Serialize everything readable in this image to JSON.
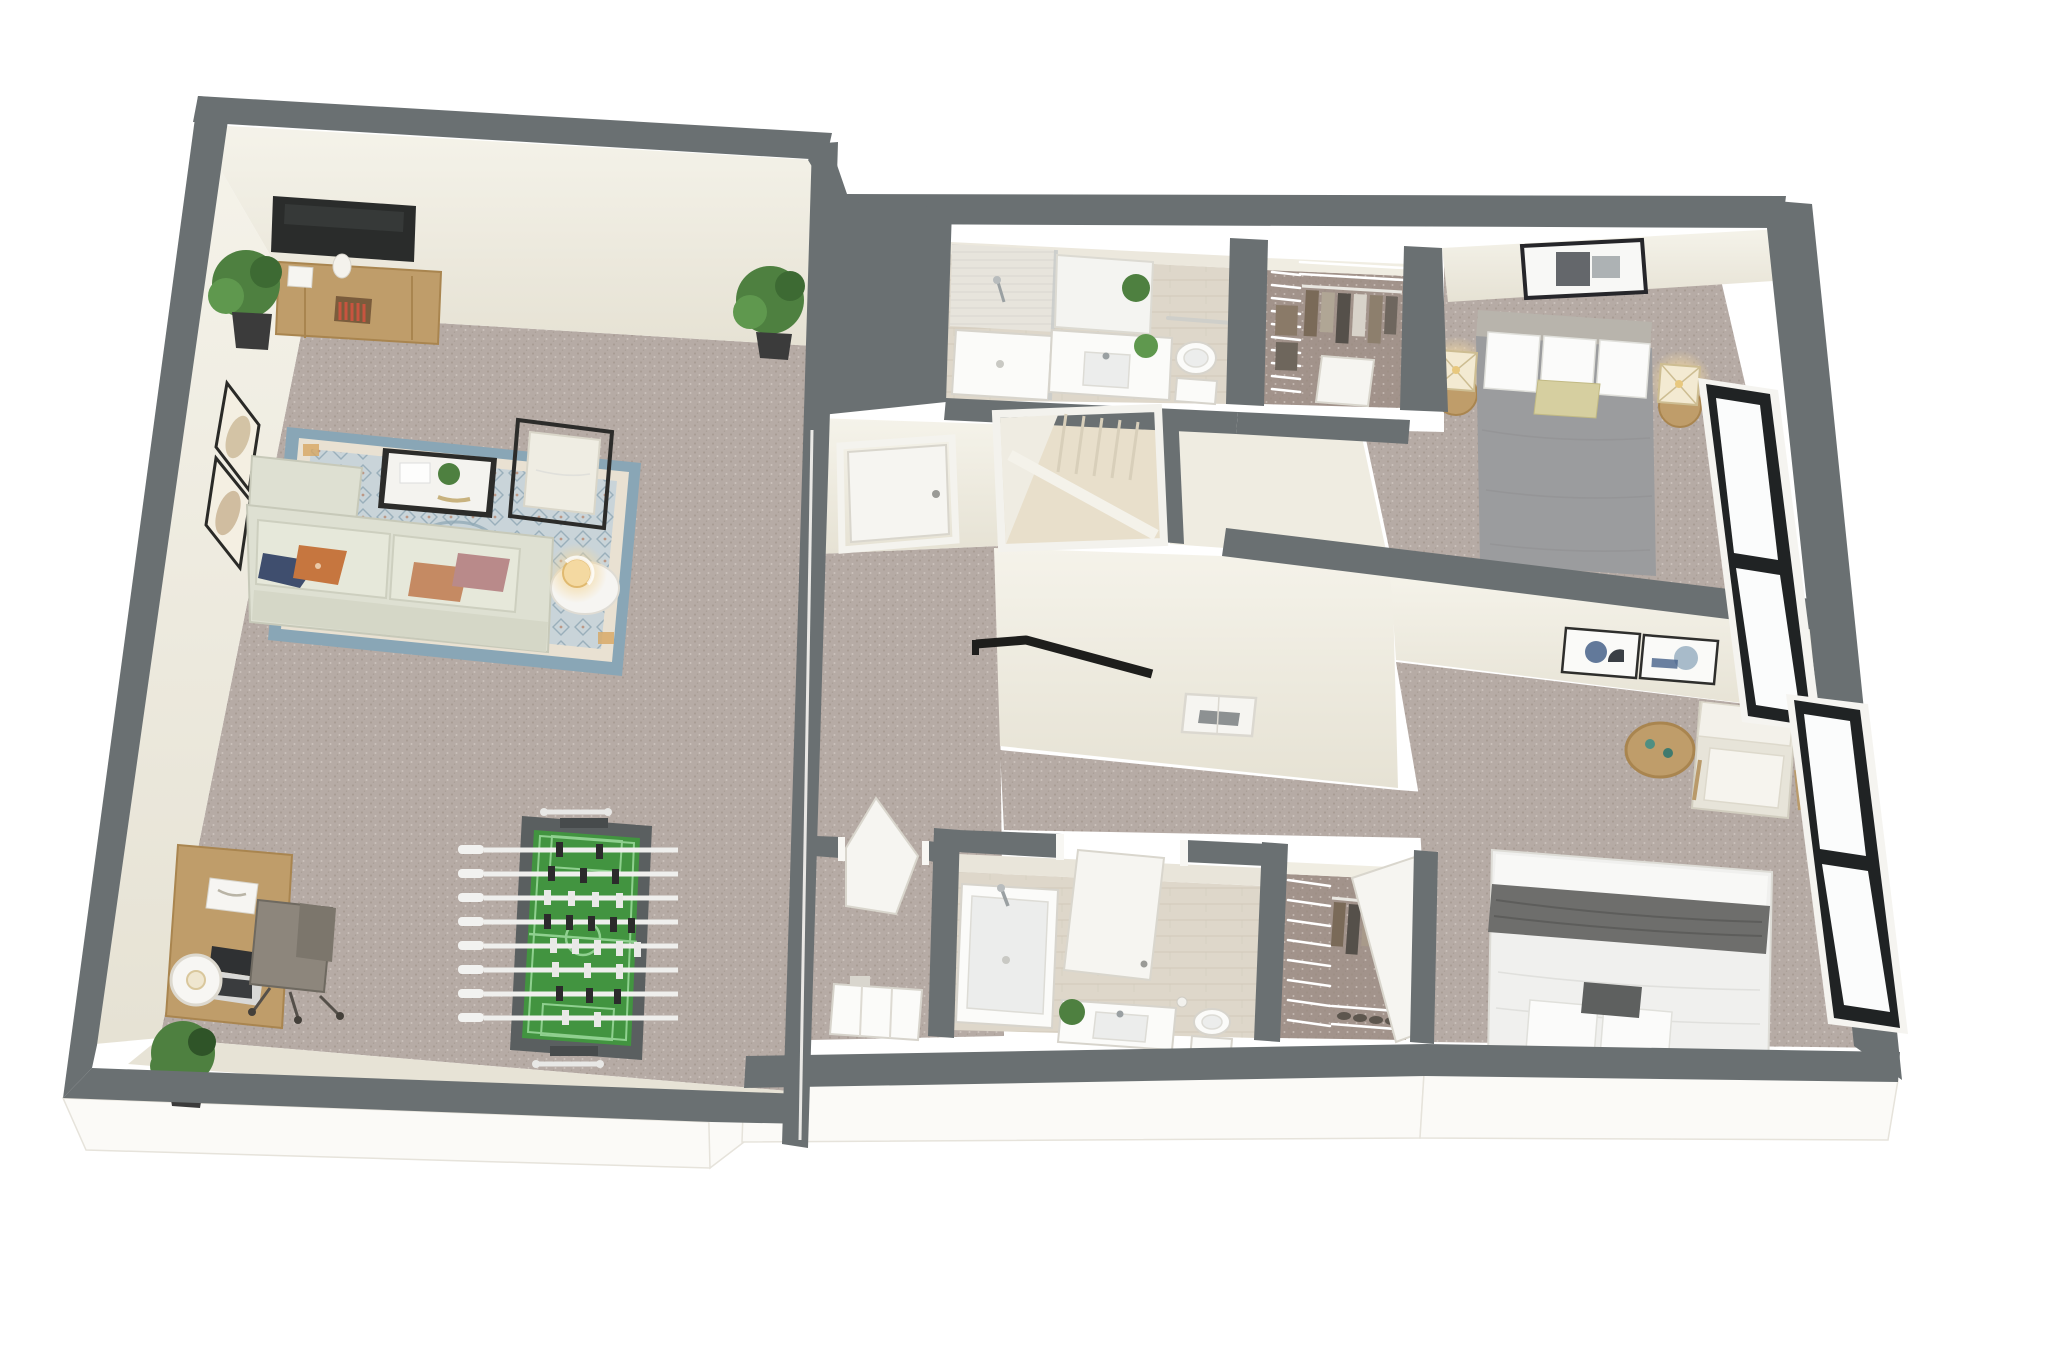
{
  "scene": {
    "type": "3d-floor-plan-rendering",
    "view": "isometric-cutaway-dollhouse-top-view",
    "rooms": [
      {
        "name": "living-rec-room",
        "floor": "carpet",
        "furniture": [
          "wall-mounted-tv",
          "media-console",
          "decor-vase",
          "potted-plant-northwest",
          "potted-plant-northeast",
          "potted-plant-southwest",
          "wall-art-frame-upper",
          "wall-art-frame-lower",
          "area-rug",
          "sectional-sofa-with-chaise",
          "throw-pillow-navy",
          "throw-pillow-orange",
          "throw-pillow-salmon",
          "throw-pillow-mauve",
          "coffee-table",
          "accent-chair",
          "side-table",
          "table-lamp-lit",
          "desk",
          "laptop",
          "desk-tray",
          "desk-lamp",
          "office-chair",
          "foosball-table"
        ]
      },
      {
        "name": "hallway",
        "floor": "carpet",
        "furniture": [
          "bathroom-door",
          "laundry-closet-door",
          "stair-opening",
          "staircase",
          "stair-handrail",
          "wall-niche-panel"
        ]
      },
      {
        "name": "bathroom-top",
        "floor": "tile",
        "furniture": [
          "walk-in-shower",
          "shower-head",
          "vanity-mirror",
          "vanity-counter",
          "sink",
          "plant-decor",
          "toilet",
          "towel-bar"
        ]
      },
      {
        "name": "walk-in-closet-top",
        "floor": "carpet",
        "furniture": [
          "wire-shelving",
          "hanging-clothes",
          "closet-door"
        ]
      },
      {
        "name": "bedroom-top-right",
        "floor": "carpet",
        "furniture": [
          "wall-art-frame",
          "queen-bed-gray-duvet",
          "pillows-white",
          "accent-pillow-yellow",
          "nightstand-left",
          "nightstand-right",
          "table-lamp-lit-left",
          "table-lamp-lit-right",
          "tall-window"
        ]
      },
      {
        "name": "laundry-closet",
        "floor": "carpet",
        "furniture": [
          "open-door",
          "white-cabinet"
        ]
      },
      {
        "name": "bathroom-bottom",
        "floor": "tile",
        "furniture": [
          "bathtub",
          "tub-faucet",
          "open-door",
          "vanity-counter",
          "sink",
          "plant-decor",
          "toilet",
          "paper-holder"
        ]
      },
      {
        "name": "walk-in-closet-bottom",
        "floor": "carpet",
        "furniture": [
          "wire-shelving",
          "hanging-clothes",
          "shoe-shelf",
          "closet-door"
        ]
      },
      {
        "name": "bedroom-bottom-right",
        "floor": "carpet",
        "furniture": [
          "wall-art-frame-left",
          "wall-art-frame-right",
          "round-side-table",
          "armchair-white",
          "bed-white-with-gray-throw",
          "pillows-white",
          "accent-pillow-dark",
          "tall-window"
        ]
      }
    ]
  },
  "palette": {
    "background": "#ffffff",
    "wall_top": "#6a7072",
    "wall_face": "#f1eee4",
    "fascia": "#fbfaf7",
    "carpet": "#b6aba5",
    "carpet_dark": "#a2938b",
    "tile": "#ded7ca",
    "stair_wood": "#e8dfcb",
    "rug_border": "#89a6b6",
    "rug_inner": "#e9e1d2",
    "rug_field": "#c9d4d9",
    "rug_accent": "#d7a661",
    "sofa": "#dee0d2",
    "wood": "#bf9d6a",
    "tv": "#2a2c2b",
    "foosball_frame": "#5a5f60",
    "foosball_field": "#429440",
    "bed1_duvet": "#9b9c9e",
    "bed2_white": "#f0f0ee",
    "throw_dark": "#6e6e6c",
    "accent_pillow": "#d6cfa0",
    "window_frame": "#202324",
    "handrail": "#1e1e1c",
    "plant_green": "#4e8040",
    "lamp_glow": "#f4d9a1"
  }
}
